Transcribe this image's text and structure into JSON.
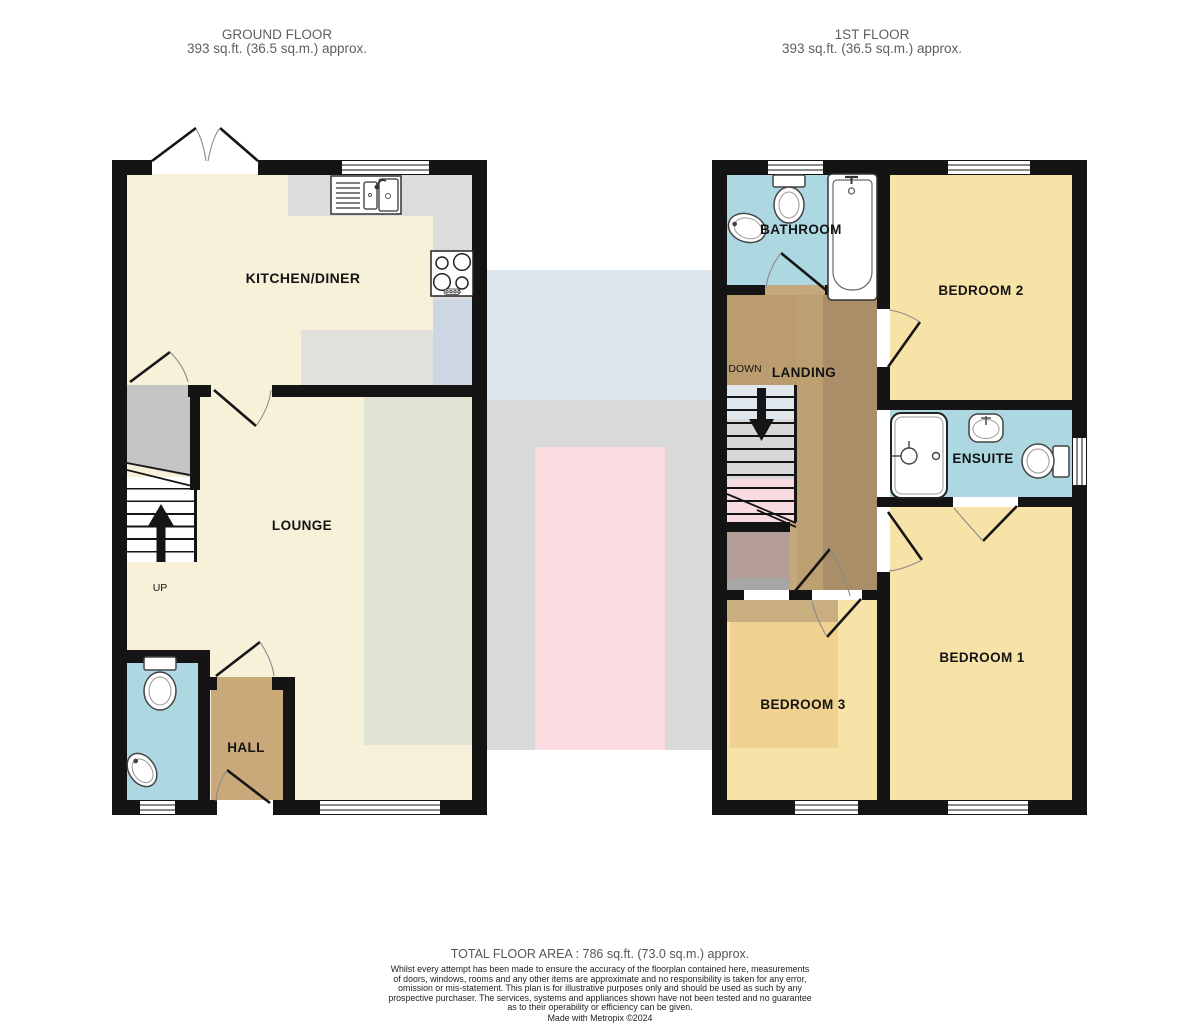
{
  "floors": {
    "ground": {
      "title": "GROUND FLOOR",
      "area": "393 sq.ft. (36.5 sq.m.) approx.",
      "rooms": {
        "kitchen": "KITCHEN/DINER",
        "lounge": "LOUNGE",
        "hall": "HALL"
      },
      "stair_label": "UP"
    },
    "first": {
      "title": "1ST FLOOR",
      "area": "393 sq.ft. (36.5 sq.m.) approx.",
      "rooms": {
        "bathroom": "BATHROOM",
        "bedroom2": "BEDROOM 2",
        "landing": "LANDING",
        "ensuite": "ENSUITE",
        "bedroom1": "BEDROOM 1",
        "bedroom3": "BEDROOM 3"
      },
      "stair_label": "DOWN"
    }
  },
  "footer": {
    "total_area": "TOTAL FLOOR AREA : 786 sq.ft. (73.0 sq.m.) approx.",
    "disclaimer": "Whilst every attempt has been made to ensure the accuracy of the floorplan contained here, measurements\nof doors, windows, rooms and any other items are approximate and no responsibility is taken for any error,\nomission or mis-statement. This plan is for illustrative purposes only and should be used as such by any\nprospective purchaser. The services, systems and appliances shown have not been tested and no guarantee\nas to their operability or efficiency can be given.",
    "credit": "Made with Metropix ©2024"
  },
  "colors": {
    "wall": "#141414",
    "label": "#141414",
    "header": "#5f5f5f",
    "footer": "#555555",
    "disc": "#222222",
    "cream": "#f7f1da",
    "yellow": "#f7e2a7",
    "blue": "#aed8e1",
    "tan": "#c9a87a",
    "landingtan": "#c5a87c",
    "counter": "#dcdcdc",
    "cupboard": "#c4c4c4",
    "ghostblue": "#dce4ee",
    "ghostgray": "#d9d9d9",
    "ghostpink": "#fadce1",
    "ghostgreen": "#e0e4d2",
    "ghostkgray": "#e0e0dd",
    "ghostkblue": "#ccd7e3",
    "landingdark": "#a98e67",
    "landingmid": "#bda071",
    "landingtop": "#bb9c6e",
    "pocketmauve": "#b59d97",
    "pocketgray": "#a6a6a4",
    "bed3band": "#c9ae80",
    "bed3inner": "#f0d190",
    "stairblue": "#dfe6ec",
    "stairgray": "#d8d8d8",
    "stairpink": "#f8dbe0"
  }
}
